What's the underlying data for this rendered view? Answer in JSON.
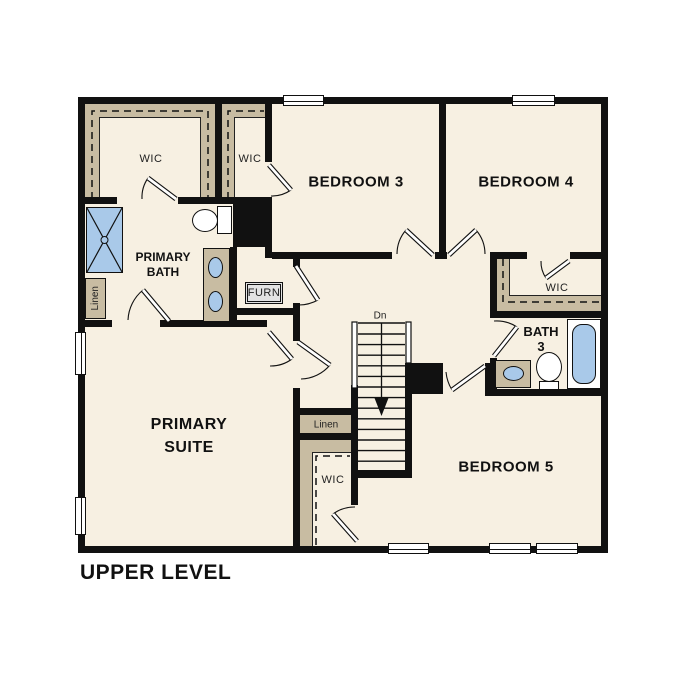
{
  "title": "UPPER LEVEL",
  "labels": {
    "primary_suite": [
      "PRIMARY",
      "SUITE"
    ],
    "primary_bath": [
      "PRIMARY",
      "BATH"
    ],
    "bedroom_3": "BEDROOM 3",
    "bedroom_4": "BEDROOM 4",
    "bedroom_5": "BEDROOM 5",
    "bath_3": [
      "BATH",
      "3"
    ],
    "wic": "WIC",
    "linen": "Linen",
    "furn": "FURN",
    "stairs_down": "Dn"
  },
  "colors": {
    "background": "#ffffff",
    "floor": "#f7f0e2",
    "walls": "#111111",
    "closet_shelving_tan": "#c8bca2",
    "fixture_blue": "#a9c9e9",
    "furnace_gray": "#e3e3e3"
  }
}
